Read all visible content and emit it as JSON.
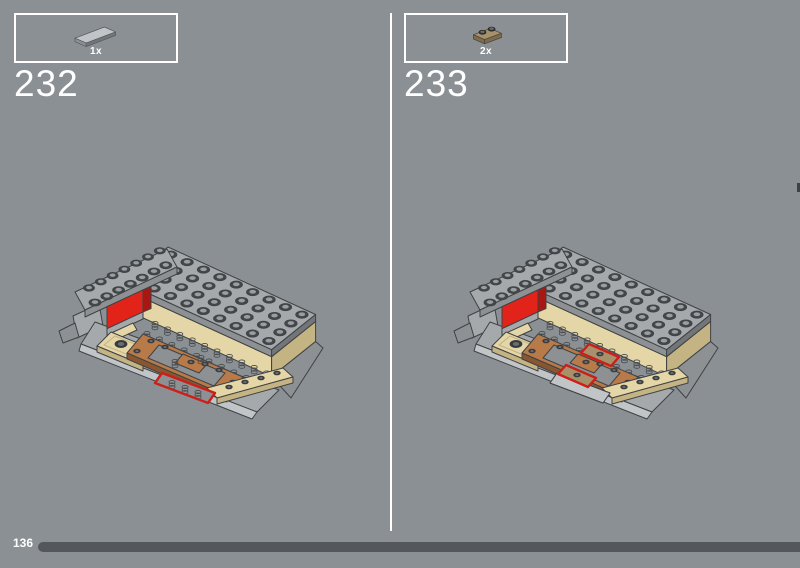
{
  "steps": [
    {
      "number": "232",
      "quantity": "1x",
      "part_icon": "tile-1x6-light-gray-icon",
      "model_icon": "hull-assembly-tile-placement-illustration"
    },
    {
      "number": "233",
      "quantity": "2x",
      "part_icon": "plate-1x2-dark-tan-icon",
      "model_icon": "hull-assembly-plates-placement-illustration"
    }
  ],
  "footer": {
    "page_number": "136"
  },
  "colors": {
    "background": "#8b9094",
    "divider": "#ffffff",
    "box_border": "#ffffff",
    "text": "#ffffff",
    "progress_bar": "#54585c",
    "lego": {
      "gray": "#a6a9ab",
      "grayLight": "#c2c5c7",
      "grayMid": "#8e9193",
      "grayDark": "#737678",
      "outline": "#3f4245",
      "studDark": "#44474a",
      "studInner": "#9b9ea1",
      "coil": "#4a4d50",
      "red": "#e2231a",
      "redDark": "#a81711",
      "highlight": "#cc1f1a",
      "tan": "#e5d6a7",
      "tanDark": "#c4b383",
      "darkTan": "#a6916b",
      "darkTanDark": "#7c6b4e",
      "brown": "#b97a49",
      "brownDark": "#8a5630",
      "hole": "#35383a",
      "holeInner": "#6a6d70"
    }
  }
}
